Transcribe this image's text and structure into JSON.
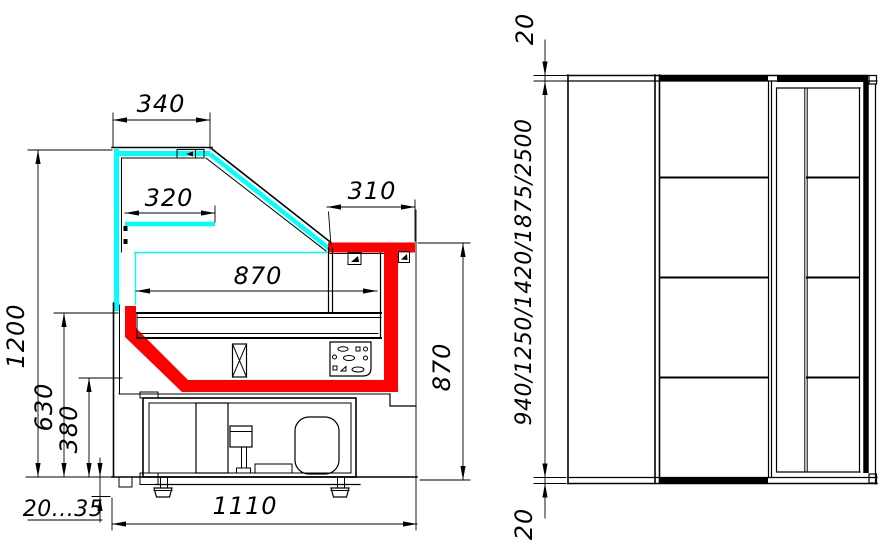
{
  "drawing": {
    "background": "#ffffff",
    "line_color": "#000000",
    "glass_color": "#00ffff",
    "accent_color": "#ff0000",
    "section_view": {
      "dim_top_glass_width": "340",
      "dim_shelf_width": "320",
      "dim_counter_top_depth": "310",
      "dim_display_area_width": "870",
      "dim_overall_height": "1200",
      "dim_deck_height": "630",
      "dim_lower_front_height": "380",
      "dim_leg_adjust_range": "20...35",
      "dim_base_depth": "1110",
      "dim_counter_height": "870"
    },
    "plan_view": {
      "dim_top_end_overhang": "20",
      "dim_length_options": "940/1250/1420/1875/2500",
      "dim_bottom_end_overhang": "20"
    }
  }
}
